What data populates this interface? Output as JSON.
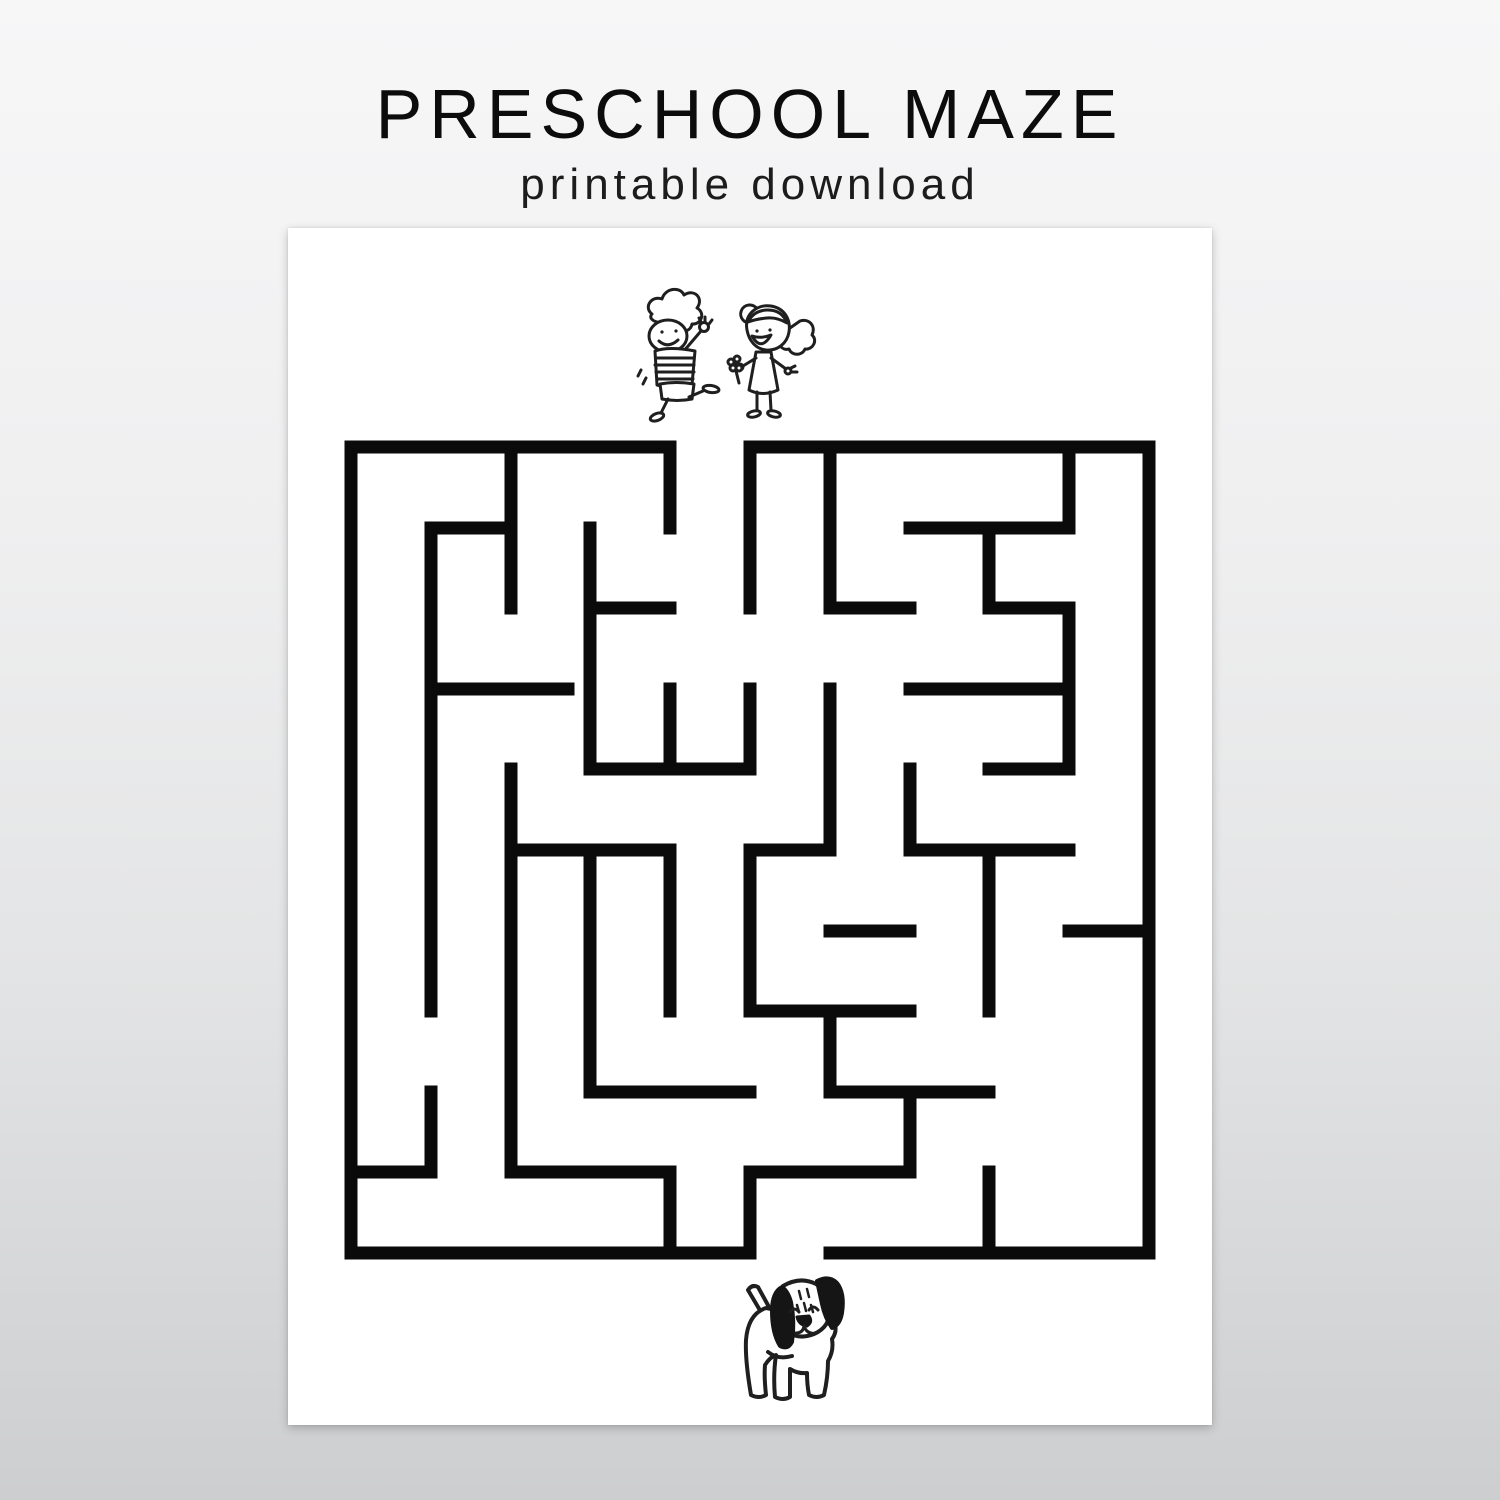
{
  "header": {
    "title": "PRESCHOOL MAZE",
    "subtitle": "printable download"
  },
  "colors": {
    "background_top": "#f7f7f8",
    "background_bottom": "#cdced0",
    "page": "#ffffff",
    "maze_wall": "#0a0a0a",
    "doodle_stroke": "#1f1f1f"
  },
  "page_sheet": {
    "description": "white printable sheet centered on gray gradient backdrop"
  },
  "maze": {
    "rows": 10,
    "cols": 10,
    "bounds": {
      "x": 351,
      "y": 447,
      "width": 798,
      "height": 806
    },
    "cell_size": {
      "w": 79.8,
      "h": 80.6
    },
    "wall_thickness": 13,
    "entrance": {
      "side": "top",
      "column_index": 4,
      "gap_x": [
        670,
        750
      ]
    },
    "exit": {
      "side": "bottom",
      "column_index": 5,
      "gap_x": [
        750,
        830
      ]
    },
    "walls": [
      [
        351,
        447,
        670,
        447
      ],
      [
        750,
        447,
        1149,
        447
      ],
      [
        431,
        528,
        511,
        528
      ],
      [
        910,
        528,
        1069,
        528
      ],
      [
        590,
        608,
        670,
        608
      ],
      [
        830,
        608,
        910,
        608
      ],
      [
        989,
        608,
        1069,
        608
      ],
      [
        431,
        689,
        568,
        689
      ],
      [
        910,
        689,
        1069,
        689
      ],
      [
        590,
        769,
        750,
        769
      ],
      [
        989,
        769,
        1069,
        769
      ],
      [
        511,
        850,
        670,
        850
      ],
      [
        750,
        850,
        830,
        850
      ],
      [
        910,
        850,
        1069,
        850
      ],
      [
        830,
        931,
        910,
        931
      ],
      [
        1069,
        931,
        1149,
        931
      ],
      [
        750,
        1011,
        910,
        1011
      ],
      [
        590,
        1092,
        750,
        1092
      ],
      [
        830,
        1092,
        989,
        1092
      ],
      [
        351,
        1172,
        431,
        1172
      ],
      [
        511,
        1172,
        670,
        1172
      ],
      [
        750,
        1172,
        910,
        1172
      ],
      [
        351,
        1253,
        750,
        1253
      ],
      [
        830,
        1253,
        1149,
        1253
      ],
      [
        351,
        447,
        351,
        1253
      ],
      [
        431,
        528,
        431,
        1011
      ],
      [
        431,
        1092,
        431,
        1172
      ],
      [
        511,
        447,
        511,
        608
      ],
      [
        511,
        769,
        511,
        1172
      ],
      [
        590,
        528,
        590,
        769
      ],
      [
        590,
        850,
        590,
        1092
      ],
      [
        670,
        447,
        670,
        528
      ],
      [
        670,
        689,
        670,
        769
      ],
      [
        670,
        850,
        670,
        1011
      ],
      [
        670,
        1172,
        670,
        1253
      ],
      [
        750,
        447,
        750,
        608
      ],
      [
        750,
        689,
        750,
        769
      ],
      [
        750,
        850,
        750,
        1011
      ],
      [
        750,
        1172,
        750,
        1253
      ],
      [
        830,
        447,
        830,
        608
      ],
      [
        830,
        689,
        830,
        850
      ],
      [
        830,
        1011,
        830,
        1092
      ],
      [
        910,
        769,
        910,
        850
      ],
      [
        910,
        1092,
        910,
        1172
      ],
      [
        989,
        528,
        989,
        608
      ],
      [
        989,
        850,
        989,
        1011
      ],
      [
        989,
        1172,
        989,
        1253
      ],
      [
        1069,
        447,
        1069,
        528
      ],
      [
        1069,
        608,
        1069,
        769
      ],
      [
        1149,
        447,
        1149,
        1253
      ]
    ]
  },
  "illustrations": {
    "start_marker": "boy waving and girl holding flower (maze start, top)",
    "goal_marker": "puppy dog with black floppy ears (maze goal, bottom)"
  }
}
